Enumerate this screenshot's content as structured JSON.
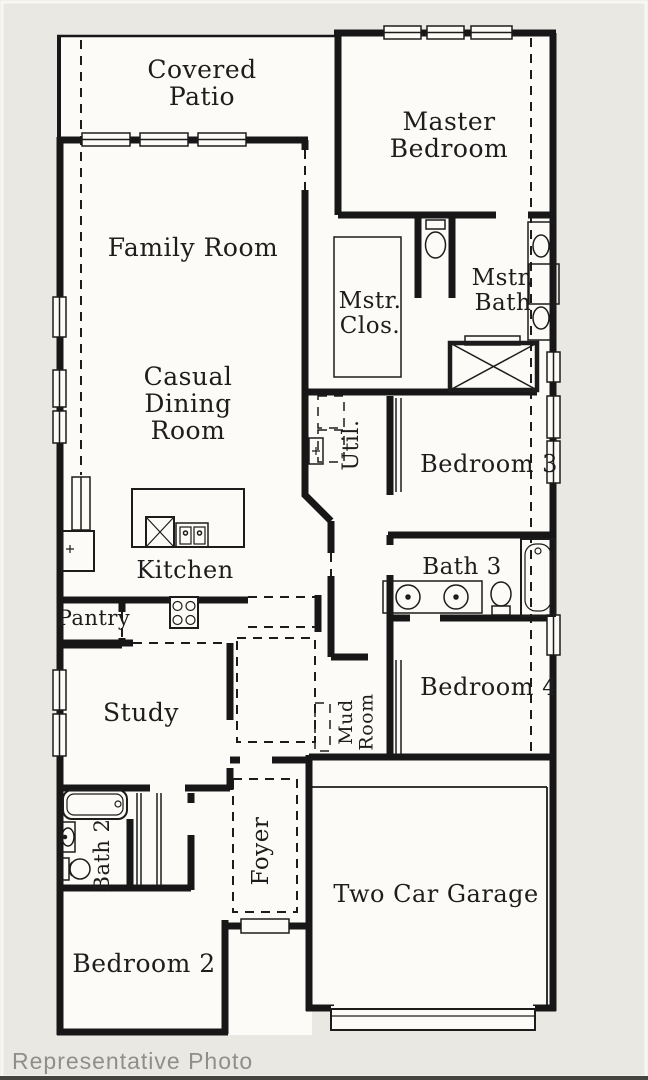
{
  "caption": {
    "text": "Representative Photo"
  },
  "colors": {
    "background": "#eae8e2",
    "plan": "#fcfbf7",
    "wall": "#171717",
    "caption_text": "#8f8f8a",
    "bottom_bar": "#45443f"
  },
  "rooms": [
    {
      "id": "covered-patio",
      "lines": [
        "Covered",
        "Patio"
      ],
      "x": 202,
      "y": 78,
      "size": 25,
      "rotate": 0
    },
    {
      "id": "family-room",
      "lines": [
        "Family Room"
      ],
      "x": 193,
      "y": 256,
      "size": 25,
      "rotate": 0
    },
    {
      "id": "master-bedroom",
      "lines": [
        "Master",
        "Bedroom"
      ],
      "x": 449,
      "y": 130,
      "size": 25,
      "rotate": 0
    },
    {
      "id": "master-closet",
      "lines": [
        "Mstr.",
        "Clos."
      ],
      "x": 370,
      "y": 308,
      "size": 23,
      "rotate": 0
    },
    {
      "id": "master-bath",
      "lines": [
        "Mstr.",
        "Bath"
      ],
      "x": 503,
      "y": 285,
      "size": 23,
      "rotate": 0
    },
    {
      "id": "casual-dining-room",
      "lines": [
        "Casual",
        "Dining",
        "Room"
      ],
      "x": 188,
      "y": 385,
      "size": 25,
      "rotate": 0
    },
    {
      "id": "utility",
      "lines": [
        "Util."
      ],
      "x": 358,
      "y": 445,
      "size": 22,
      "rotate": -90
    },
    {
      "id": "bedroom-3",
      "lines": [
        "Bedroom 3"
      ],
      "x": 489,
      "y": 472,
      "size": 24,
      "rotate": 0
    },
    {
      "id": "kitchen",
      "lines": [
        "Kitchen"
      ],
      "x": 185,
      "y": 578,
      "size": 24,
      "rotate": 0
    },
    {
      "id": "bath-3",
      "lines": [
        "Bath 3"
      ],
      "x": 462,
      "y": 574,
      "size": 23,
      "rotate": 0
    },
    {
      "id": "pantry",
      "lines": [
        "Pantry"
      ],
      "x": 94,
      "y": 625,
      "size": 21,
      "rotate": 0
    },
    {
      "id": "study",
      "lines": [
        "Study"
      ],
      "x": 141,
      "y": 721,
      "size": 25,
      "rotate": 0
    },
    {
      "id": "mud-room",
      "lines": [
        "Mud",
        "Room"
      ],
      "x": 352,
      "y": 722,
      "size": 19,
      "rotate": -90
    },
    {
      "id": "bedroom-4",
      "lines": [
        "Bedroom 4"
      ],
      "x": 489,
      "y": 695,
      "size": 24,
      "rotate": 0
    },
    {
      "id": "bath-2",
      "lines": [
        "Bath 2"
      ],
      "x": 109,
      "y": 855,
      "size": 21,
      "rotate": -90
    },
    {
      "id": "foyer",
      "lines": [
        "Foyer"
      ],
      "x": 268,
      "y": 851,
      "size": 23,
      "rotate": -90
    },
    {
      "id": "two-car-garage",
      "lines": [
        "Two Car Garage"
      ],
      "x": 436,
      "y": 902,
      "size": 24,
      "rotate": 0
    },
    {
      "id": "bedroom-2",
      "lines": [
        "Bedroom 2"
      ],
      "x": 144,
      "y": 972,
      "size": 25,
      "rotate": 0
    }
  ],
  "fixtures": [
    "kitchen-island-sink",
    "dishwasher",
    "range",
    "refrigerator",
    "tall-cabinet",
    "master-shower",
    "master-wc-toilet",
    "master-vanity-sinks",
    "bath3-vanity-sinks",
    "bath3-toilet",
    "bath3-tub",
    "bath2-tub",
    "bath2-sink",
    "bath2-toilet",
    "utility-sink",
    "washer-dryer-space",
    "mud-bench",
    "garage-door",
    "entry-door"
  ]
}
